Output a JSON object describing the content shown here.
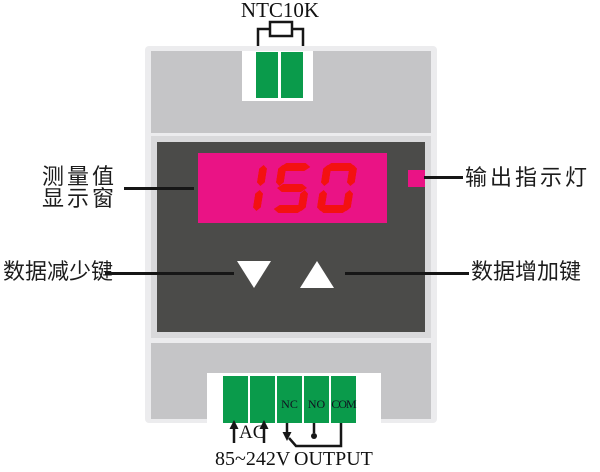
{
  "device": {
    "sensor_label": "NTC10K",
    "display": {
      "value": "150"
    },
    "terminal_labels": [
      "NC",
      "NO",
      "COM"
    ],
    "power_label": "AC",
    "voltage_label": "85~242V",
    "output_label": "OUTPUT"
  },
  "callouts": {
    "display_window_line1": "测量值",
    "display_window_line2": "显示窗",
    "output_indicator": "输出指示灯",
    "decrease_key": "数据减少键",
    "increase_key": "数据增加键"
  },
  "colors": {
    "display_background": "#ea1385",
    "digit_red": "#f31111",
    "terminal_green": "#0a9b4b",
    "panel_dark": "#4b4b49",
    "body_gray": "#c5c5c7",
    "frame_light": "#ececee"
  }
}
